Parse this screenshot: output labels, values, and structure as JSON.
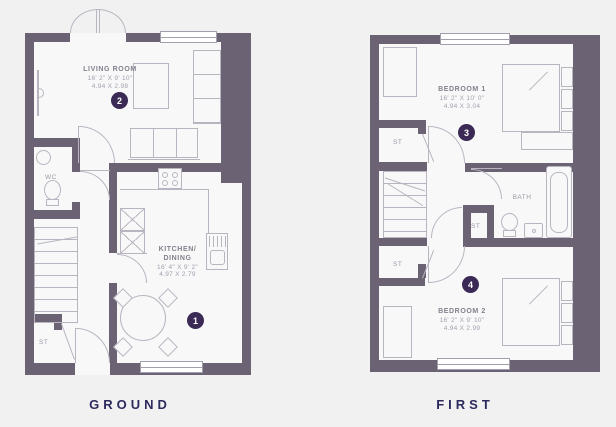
{
  "colors": {
    "background": "#f2f1f1",
    "wall": "#6b6373",
    "furniture_line": "#b9b5c0",
    "badge_background": "#3a2a55",
    "badge_text": "#ffffff",
    "floor_label_text": "#2d2a5e"
  },
  "ground": {
    "floor_label": "GROUND",
    "living": {
      "name": "LIVING ROOM",
      "imperial": "16' 2\" X 9' 10\"",
      "metric": "4.94 X 2.98",
      "badge": "2"
    },
    "kitchen": {
      "name_line1": "KITCHEN/",
      "name_line2": "DINING",
      "imperial": "16' 4\" X 9' 2\"",
      "metric": "4.97 X 2.79",
      "badge": "1"
    },
    "wc": "WC",
    "store": "ST"
  },
  "first": {
    "floor_label": "FIRST",
    "bedroom1": {
      "name": "BEDROOM 1",
      "imperial": "16' 2\" X 10' 0\"",
      "metric": "4.94 X 3.04",
      "badge": "3"
    },
    "bedroom2": {
      "name": "BEDROOM 2",
      "imperial": "16' 2\" X 9' 10\"",
      "metric": "4.94 X 2.99",
      "badge": "4"
    },
    "bath": "BATH",
    "store_top": "ST",
    "store_mid": "ST",
    "store_bottom": "ST"
  }
}
